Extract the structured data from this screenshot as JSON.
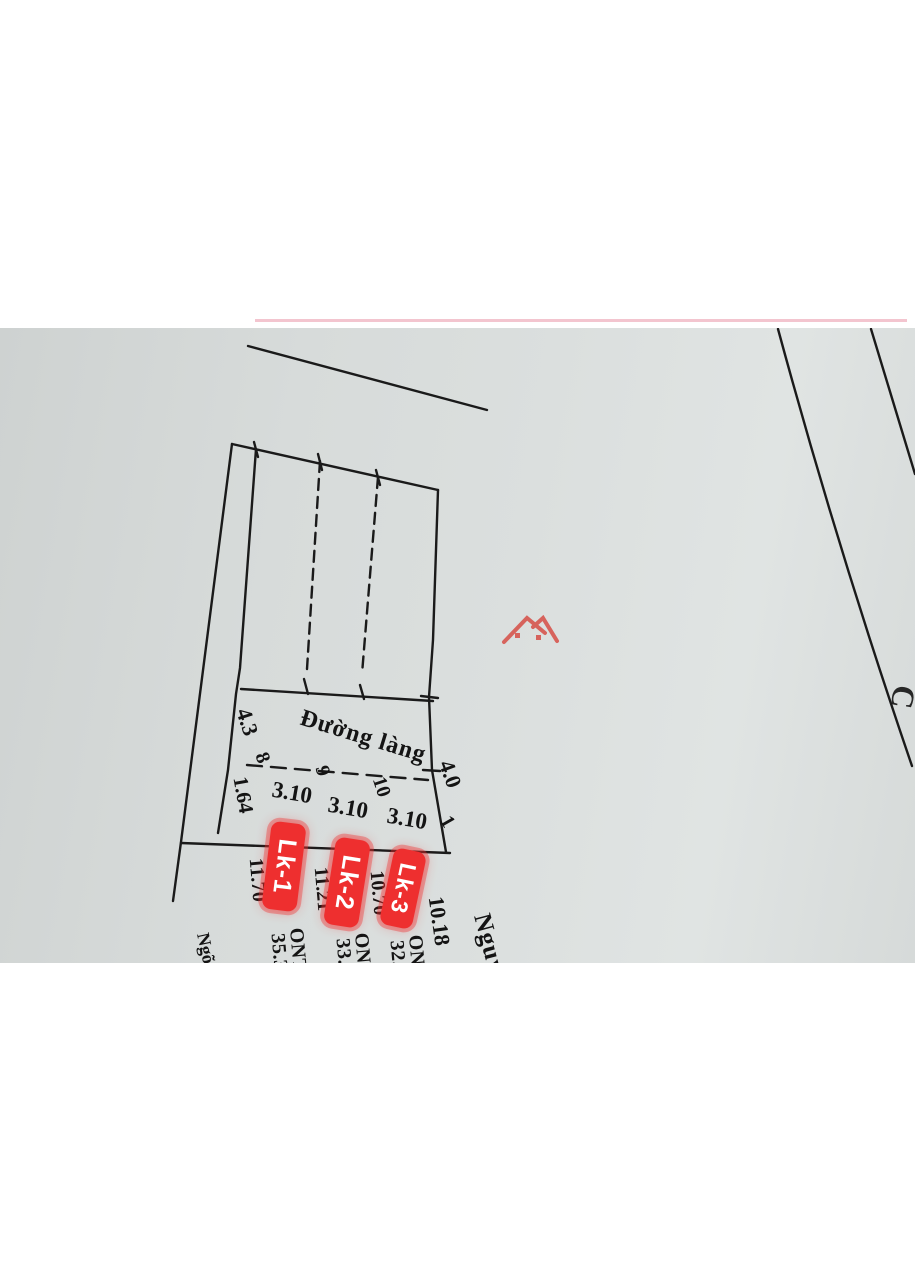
{
  "roads": {
    "top": "Đường làng",
    "right": "Nguyễn Công Đức",
    "alley": "Ngõ đi chung"
  },
  "plots": [
    {
      "label": "Lk-1",
      "land_use": "ONT",
      "area": "35.3",
      "width_top": "3.10",
      "width_bottom": "3.10",
      "depth": "11.70"
    },
    {
      "label": "Lk-2",
      "land_use": "ONT",
      "area": "33.7",
      "width_top": "3.10",
      "width_bottom": "3.10",
      "depth": "11.21"
    },
    {
      "label": "Lk-3",
      "land_use": "ONT",
      "area": "32.2",
      "width_top": "3.10",
      "width_bottom": "3.10",
      "depth": "10.70"
    },
    {
      "label": "Lk - 4",
      "land_use": "ONT",
      "area": "30.7",
      "width_bottom": "9.33"
    },
    {
      "label": "Lk - 5",
      "land_use": "ONT",
      "area": "30.8",
      "width_bottom": "9.36"
    }
  ],
  "dims": {
    "top_left": "4.3",
    "top_right": "4.0",
    "alley_width_top": "1.64",
    "alley_width_bottom": "2.58",
    "right_edge_upper": "10.18",
    "right_edge_mid": "3.30",
    "right_edge_lower": "3.30",
    "lot4_depth_left": "3.50",
    "lot4_marker": "11"
  },
  "corners": {
    "c1": "1",
    "c2": "2",
    "c3": "3",
    "c4": "4",
    "c5": "5",
    "c6": "6",
    "c7": "7",
    "c8": "8",
    "c9": "9",
    "c10": "10"
  },
  "fragments": {
    "top_right_letter": "C",
    "bottom_letter_1": "1",
    "bottom_letter_2": "A"
  },
  "watermark": {
    "name": "house-roof-logo"
  },
  "colors": {
    "highlight_red": "#ee2f2f",
    "line_black": "#1a1a1a",
    "photo_grey": "#d7dbda",
    "pink_scan_line": "#f0b6c3",
    "logo_red": "#d6453c"
  }
}
